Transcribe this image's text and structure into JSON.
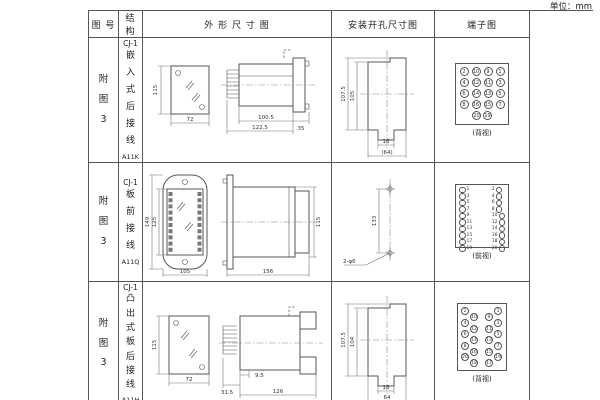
{
  "unit_label": "单位：mm",
  "headers": {
    "fig": "图 号",
    "struct": "结 构",
    "outline": "外 形 尺 寸 图",
    "cutout": "安装开孔尺寸图",
    "terminal": "端子图"
  },
  "rows": [
    {
      "fig_no": "附图3",
      "series": "CJ-1",
      "structure": "嵌入式后接线",
      "model": "A11K",
      "outline": {
        "h": "115",
        "w": "72",
        "l1": "100.5",
        "l2": "122.5",
        "d": "35"
      },
      "cutout": {
        "h1": "107.5",
        "h2": "105",
        "w1": "16",
        "w2": "(64)"
      },
      "terminal": {
        "view": "(背视)",
        "grid": [
          "2",
          "10",
          "9",
          "1",
          "4",
          "12",
          "11",
          "3",
          "6",
          "14",
          "13",
          "5",
          "8",
          "16",
          "15",
          "7"
        ],
        "bottom": [
          "20",
          "19"
        ]
      }
    },
    {
      "fig_no": "附图3",
      "series": "CJ-1",
      "structure": "板前接线",
      "model": "A11Q",
      "outline": {
        "h1": "149",
        "h2": "125",
        "w": "105",
        "l": "156",
        "h3": "115"
      },
      "cutout": {
        "dist": "133",
        "holes": "2-φ6"
      },
      "terminal": {
        "view": "(前视)",
        "left": [
          "1",
          "3",
          "5",
          "7",
          "9",
          "11",
          "13",
          "15",
          "17",
          "19"
        ],
        "right": [
          "2",
          "4",
          "6",
          "8",
          "10",
          "12",
          "14",
          "16",
          "18",
          "20"
        ]
      }
    },
    {
      "fig_no": "附图3",
      "series": "CJ-1",
      "structure": "凸出式板后接线",
      "model": "A11H",
      "outline": {
        "h": "115",
        "w": "72",
        "a": "31.5",
        "b": "9.5",
        "l": "126"
      },
      "cutout": {
        "h1": "107.5",
        "h2": "104",
        "w1": "16",
        "w2": "64"
      },
      "terminal": {
        "view": "(背视)",
        "left_outer": [
          "2",
          "4",
          "6",
          "8",
          "20"
        ],
        "left_inner": [
          "10",
          "12",
          "14",
          "16",
          "18"
        ],
        "right_inner": [
          "9",
          "11",
          "13",
          "15",
          "17"
        ],
        "right_outer": [
          "1",
          "3",
          "5",
          "7",
          "19"
        ]
      }
    }
  ]
}
